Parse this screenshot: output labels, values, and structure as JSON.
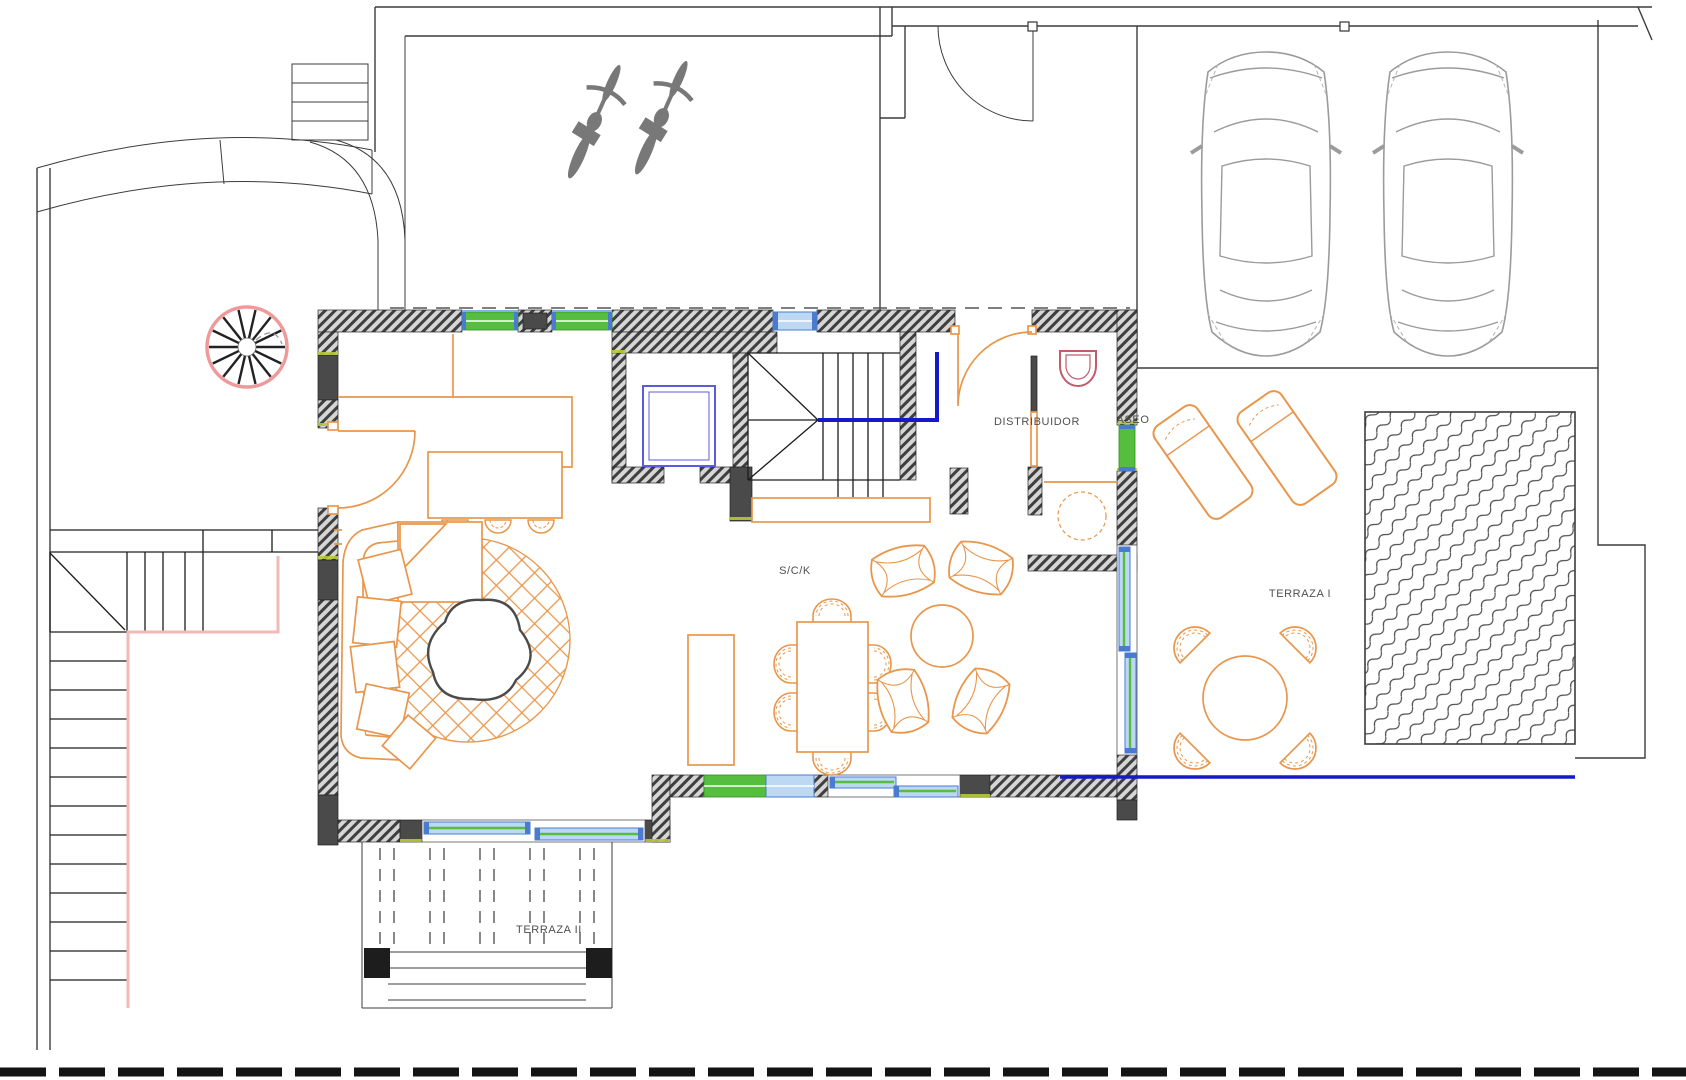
{
  "title": "Ground floor plan",
  "labels": {
    "distribuidor": "DISTRIBUIDOR",
    "aseo": "ASEO",
    "sck": "S/C/K",
    "terraza1": "TERRAZA I",
    "terraza2": "TERRAZA II"
  },
  "colors": {
    "furniture_orange": "#E8964B",
    "window_green": "#55BE3E",
    "glass_light": "#BDD8F3",
    "glass_frame": "#4A7BD0",
    "deep_blue": "#1718C9",
    "lift_blue": "#5B5BE0",
    "spiral_pink": "#EE9A9A",
    "stair_outline_pink": "#F2B9B9",
    "toilet_red": "#C25B6A",
    "line_dark": "#3C3C3C",
    "line_gray": "#9B9B9B",
    "label_gray": "#4F4F4F",
    "accent_yellow": "#B8C93A"
  },
  "features": {
    "vehicles": {
      "cars": 2,
      "bicycles": 2
    },
    "rooms": [
      "S/C/K",
      "DISTRIBUIDOR",
      "ASEO",
      "TERRAZA I",
      "TERRAZA II"
    ],
    "items": [
      "spiral-staircase",
      "exterior-staircase",
      "main-staircase",
      "elevator-shaft",
      "kitchen-island-3-stools",
      "sectional-sofa",
      "round-rug",
      "dining-table-6-chairs",
      "lounge-4-armchairs-round-table",
      "toilet",
      "wash-basin",
      "2-sun-loungers",
      "terrace-round-table-4-chairs",
      "swimming-pool",
      "glass-balustrade",
      "pergola-slats"
    ]
  }
}
